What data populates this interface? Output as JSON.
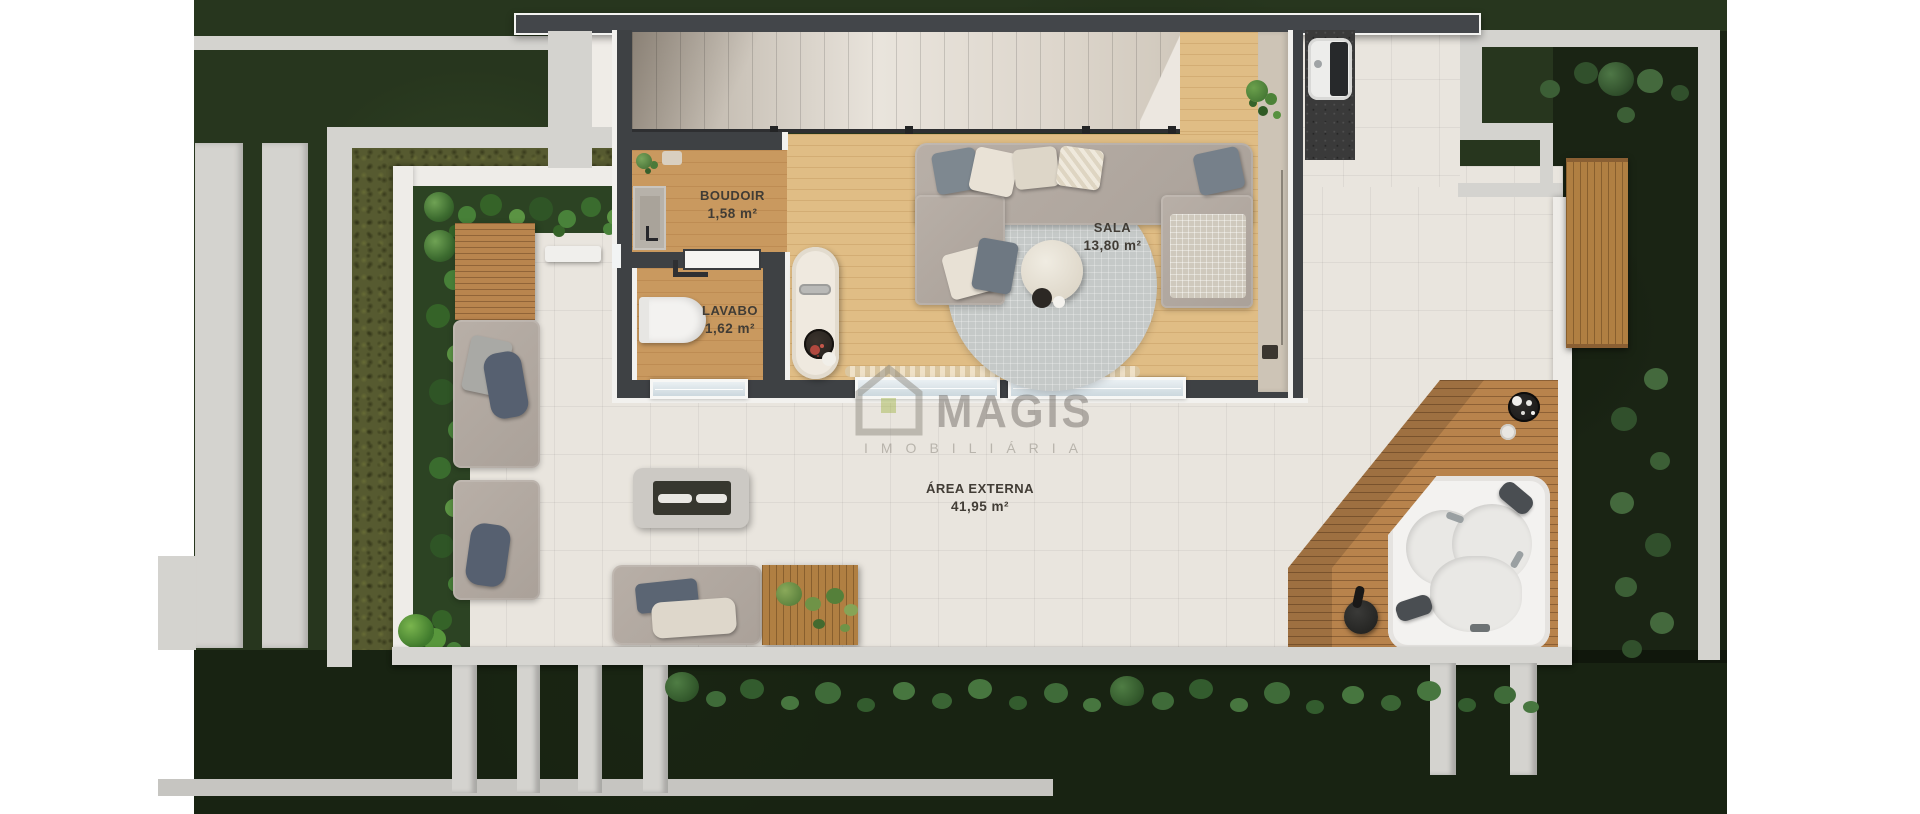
{
  "rooms": [
    {
      "id": "boudoir",
      "name": "BOUDOIR",
      "area": "1,58 m²"
    },
    {
      "id": "sala",
      "name": "SALA",
      "area": "13,80 m²"
    },
    {
      "id": "lavabo",
      "name": "LAVABO",
      "area": "1,62 m²"
    },
    {
      "id": "area-externa",
      "name": "ÁREA EXTERNA",
      "area": "41,95 m²"
    }
  ],
  "watermark": {
    "brand": "MAGIS",
    "subtitle": "IMOBILIÁRIA"
  },
  "colors": {
    "grass": "#27361e",
    "tile_floor": "#e9e5de",
    "wood_floor_light": "#e0bd85",
    "wood_floor_dark": "#c9995f",
    "deck_wood": "#b8834c",
    "wall_dark": "#3e4144",
    "wall_light": "#d4d3cf",
    "plant_green": "#4e7d3f",
    "label_text": "#413c35",
    "watermark_gray": "#68635b"
  }
}
